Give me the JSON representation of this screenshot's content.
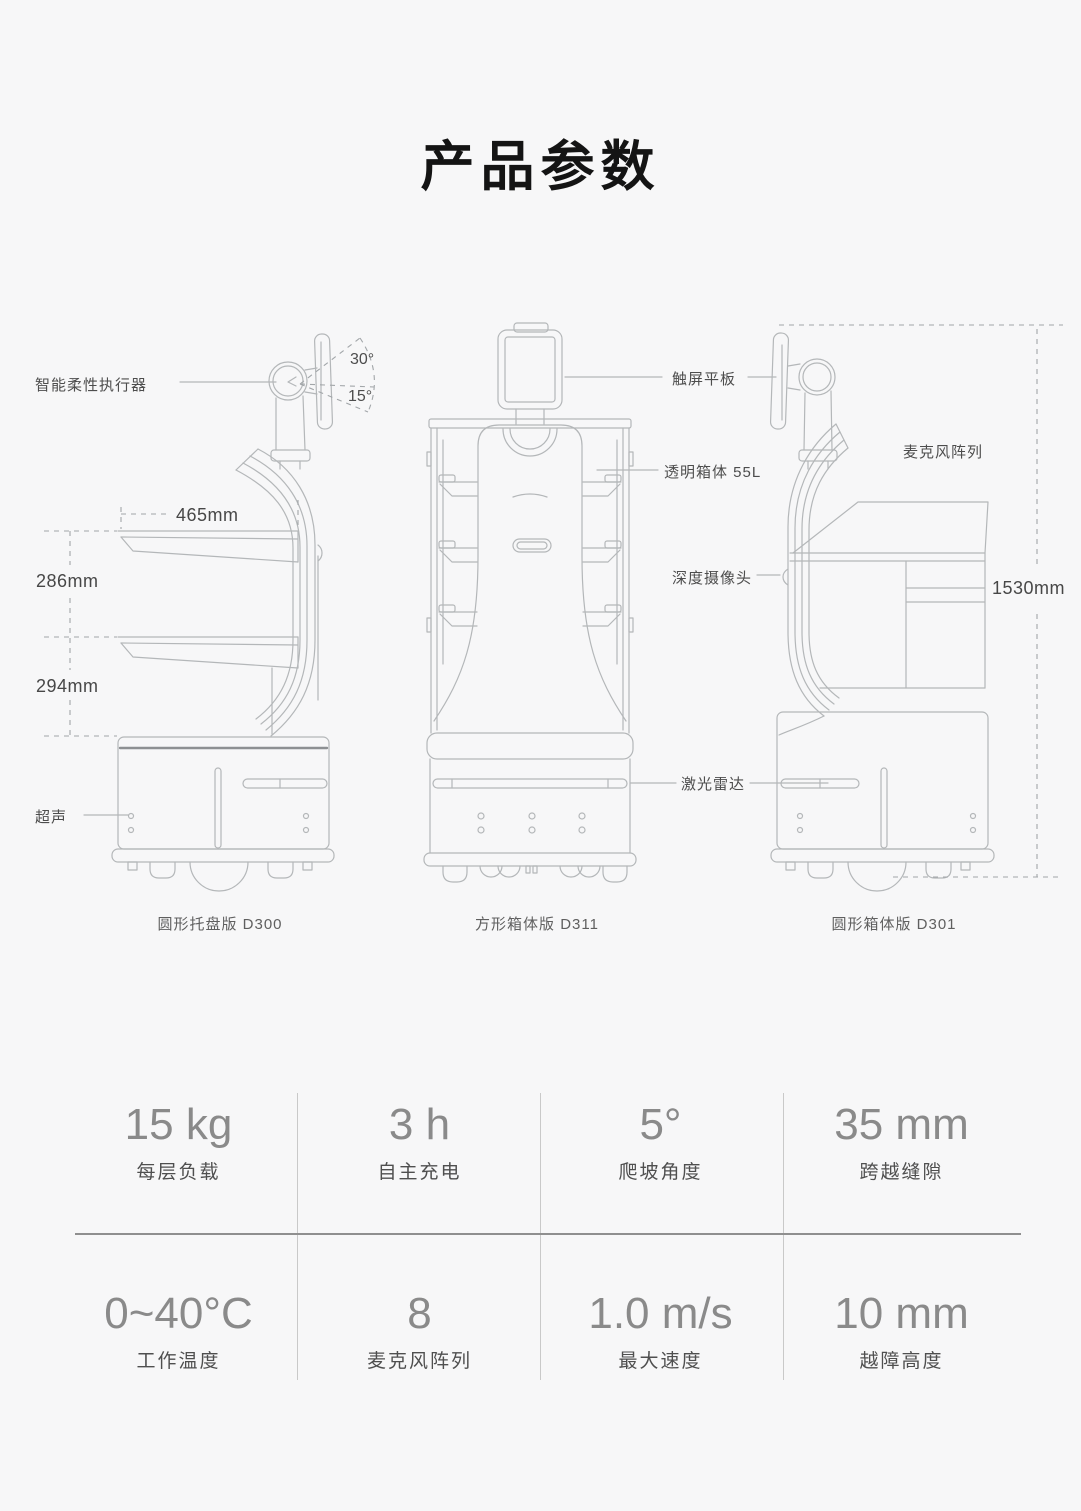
{
  "title": "产品参数",
  "diagram": {
    "labels": {
      "actuator": "智能柔性执行器",
      "angle_up": "30°",
      "angle_down": "15°",
      "tray_width": "465mm",
      "tray_gap_1": "286mm",
      "tray_gap_2": "294mm",
      "ultrasonic": "超声",
      "touchscreen": "触屏平板",
      "transparent_box": "透明箱体 55L",
      "depth_camera": "深度摄像头",
      "lidar": "激光雷达",
      "mic_array": "麦克风阵列",
      "total_height": "1530mm"
    },
    "captions": {
      "d300": "圆形托盘版 D300",
      "d311": "方形箱体版 D311",
      "d301": "圆形箱体版 D301"
    }
  },
  "specs": {
    "rows": [
      [
        {
          "value": "15 kg",
          "label": "每层负载"
        },
        {
          "value": "3 h",
          "label": "自主充电"
        },
        {
          "value": "5°",
          "label": "爬坡角度"
        },
        {
          "value": "35 mm",
          "label": "跨越缝隙"
        }
      ],
      [
        {
          "value": "0~40°C",
          "label": "工作温度"
        },
        {
          "value": "8",
          "label": "麦克风阵列"
        },
        {
          "value": "1.0 m/s",
          "label": "最大速度"
        },
        {
          "value": "10 mm",
          "label": "越障高度"
        }
      ]
    ]
  },
  "colors": {
    "background": "#f7f7f8",
    "line_art": "#b4b7b9",
    "title_text": "#141414",
    "annotation_text": "#4d4d4d",
    "spec_value_text": "#8a8a8a"
  }
}
